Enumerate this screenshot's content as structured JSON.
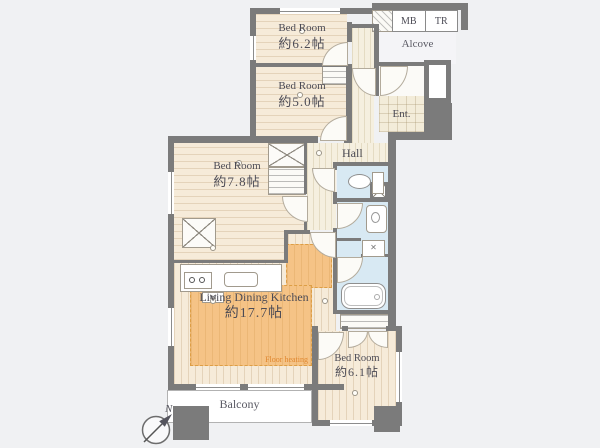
{
  "plan": {
    "type": "apartment-floor-plan",
    "rooms": {
      "bedroom_a": {
        "label": "Bed Room",
        "area": "約6.2帖"
      },
      "bedroom_b": {
        "label": "Bed Room",
        "area": "約5.0帖"
      },
      "bedroom_c": {
        "label": "Bed Room",
        "area": "約7.8帖"
      },
      "ldk": {
        "label": "Living Dining Kitchen",
        "area": "約17.7帖"
      },
      "bedroom_d": {
        "label": "Bed Room",
        "area": "約6.1帖"
      },
      "hall": {
        "label": "Hall"
      },
      "entrance": {
        "label": "Ent."
      },
      "alcove": {
        "label": "Alcove"
      },
      "balcony": {
        "label": "Balcony"
      }
    },
    "labels": {
      "meter_box": "MB",
      "trunk_room": "TR",
      "floor_heating": "Floor heating",
      "compass_north": "N"
    },
    "colors": {
      "background": "#f0f1f3",
      "wall": "#7b7b7b",
      "floor": "#f6ebd9",
      "floor_heating": "#f5c386",
      "floor_heating_text": "#e0872f",
      "wet_area": "#d8e9f3",
      "text": "#4c4b55"
    }
  }
}
